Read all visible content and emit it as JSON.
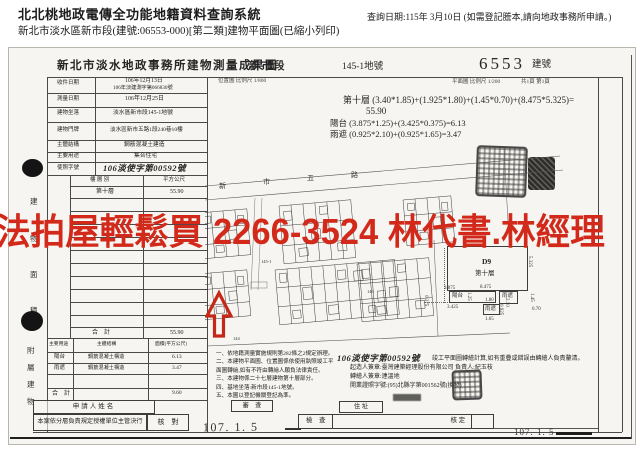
{
  "header": {
    "system_title": "北北桃地政電傳全功能地籍資料查詢系統",
    "doc_line": "新北市淡水區新市段(建號:06553-000)[第二類]建物平面圖(已縮小列印)",
    "query_date": "查詢日期:115年 3月10日 (如需登記謄本,請向地政事務所申請。)"
  },
  "doc": {
    "title": "新北市淡水地政事務所建物測量成果圖",
    "section": "新市段",
    "land_no": "145-1地號",
    "building_no": "6553",
    "building_no_label": "建號",
    "location_scale": "位置圖 比例尺 1/800",
    "plan_scale": "平面圖 比例尺 1/200",
    "page_info": "共1頁 第1頁",
    "info_rows": [
      {
        "label": "收件日期",
        "value": "106年12月13日",
        "value2": "106年淡建測字第066830號"
      },
      {
        "label": "測量日期",
        "value": "106年12月25日"
      },
      {
        "label": "建物坐落",
        "value": "淡水區新市段145-1地號"
      },
      {
        "label": "建物門牌",
        "value": "淡水區新市五路1段240巷10樓"
      },
      {
        "label": "主體結構",
        "value": "鋼筋混凝土建造"
      },
      {
        "label": "主要用途",
        "value": "集合住宅"
      },
      {
        "label": "使照字號",
        "value": "106淡使字第00592號"
      }
    ],
    "floor_table": {
      "col_floor": "樓 層 別",
      "col_area": "平方公尺",
      "floor": "第十層",
      "area": "55.90",
      "total_label": "合　計",
      "total_area": "55.90"
    },
    "annex_table": {
      "h_use": "主要用途",
      "h_struct": "主體結構",
      "h_area": "面積(平方公尺)",
      "rows": [
        {
          "use": "陽台",
          "struct": "鋼筋混凝土構造",
          "area": "6.13"
        },
        {
          "use": "雨遮",
          "struct": "鋼筋混凝土構造",
          "area": "3.47"
        }
      ],
      "total_label": "合　計",
      "total_area": "9.60"
    },
    "side_main": [
      "建",
      "物",
      "面",
      "積"
    ],
    "side_annex": [
      "附",
      "屬",
      "建",
      "物"
    ],
    "calc": [
      "第十層 (3.40*1.85)+(1.925*1.80)+(1.45*0.70)+(8.475*5.325)=",
      "55.90",
      "陽台 (3.875*1.25)+(3.425*0.375)=6.13",
      "雨遮 (0.925*2.10)+(0.925*1.65)=3.47"
    ],
    "notes": [
      "一、依地籍測量實施規則第282條之2規定辦理。",
      "二、本建物平面圖、位置圖係依使用執照竣工平面圖轉繪,如有不符由轉繪人願負法律責任。",
      "三、本建物係二十七層建物第十層部分。",
      "四、基地坐落:新市段145-1地號。",
      "五、本圖以登記機關登記為準。"
    ],
    "permit": {
      "no": "106淡使字第00592號",
      "text": "竣工平面圖轉繪計算,如有重疊或錯誤由轉繪人負責釐清。",
      "builder": "起造人簽章:臺灣建築經理股份有限公司 負責人:紀玉枝",
      "drafter": "轉繪人簽章:連溫地",
      "license": "開業證照字號:(95)北縣字第001562號(換發)"
    },
    "bottom": {
      "applicant": "申請人姓名",
      "authorize": "本案依分層負責規定授權單位主管決行",
      "check": "核　對",
      "review": "審　查",
      "address": "住 址",
      "inspect": "檢　查",
      "approve": "核 定",
      "date_left": "107. 1. 5",
      "date_right": "107. 1. 5"
    },
    "watermark": "法拍屋輕鬆買 2266-3524 林代書.林經理",
    "site": {
      "roads": [
        "新",
        "市",
        "五",
        "路"
      ],
      "parcels": [
        "145-1",
        "146",
        "144"
      ]
    },
    "detail": {
      "unit": "D9",
      "floor": "第十層",
      "balcony": "陽台",
      "canopy": "雨遮",
      "canopy2": "雨遮",
      "d_top": "8.475",
      "d_right": "5.325",
      "d_b1": "3.875",
      "d_b2": "3.425",
      "d_b3": "0.375",
      "d_b4": "1.25",
      "d_c1": "2.10",
      "d_c2": "1.45",
      "d_c3": "0.70",
      "d_c4": "1.80",
      "d_c5": "1.65",
      "d_c6": "0.925"
    },
    "colors": {
      "watermark_red": "#d2291a",
      "arrow_red": "#c62817"
    }
  }
}
